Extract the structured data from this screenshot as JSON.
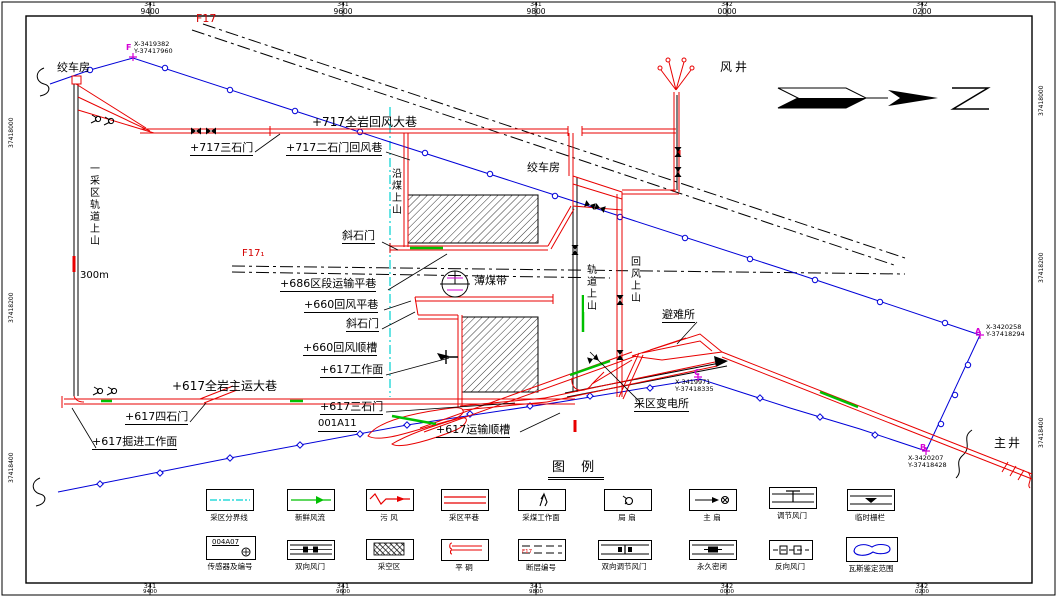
{
  "frame": {
    "top_ticks": [
      {
        "minor": "341",
        "major": "9400"
      },
      {
        "minor": "341",
        "major": "9600"
      },
      {
        "minor": "341",
        "major": "9800"
      },
      {
        "minor": "342",
        "major": "0000"
      },
      {
        "minor": "342",
        "major": "0200"
      }
    ],
    "bottom_ticks": [
      {
        "minor": "341",
        "major": "9400"
      },
      {
        "minor": "341",
        "major": "9600"
      },
      {
        "minor": "341",
        "major": "9800"
      },
      {
        "minor": "342",
        "major": "0000"
      },
      {
        "minor": "342",
        "major": "0200"
      }
    ],
    "left_ticks": [
      "37418000",
      "37418200",
      "37418400"
    ],
    "right_ticks": [
      "37418000",
      "37418200",
      "37418400"
    ]
  },
  "map": {
    "labels": {
      "winch_house_1": "绞车房",
      "winch_house_2": "绞车房",
      "fault_f17": "F17",
      "fault_f17_1": "F17₁",
      "return_717": "+717全岩回风大巷",
      "crosscut3_717": "+717三石门",
      "crosscut2_717": "+717二石门回风巷",
      "yanmei_rise": "沿煤上山",
      "air_shaft": "风井",
      "incline_crosscut_1": "斜石门",
      "incline_crosscut_2": "斜石门",
      "transport_686": "+686区段运输平巷",
      "thin_coal": "薄煤带",
      "return_level_660": "+660回风平巷",
      "return_gate_660": "+660回风顺槽",
      "face_617": "+617工作面",
      "main_haulage_617": "+617全岩主运大巷",
      "crosscut3_617": "+617三石门",
      "code_001a11": "001A11",
      "transport_gate_617": "+617运输顺槽",
      "crosscut4_617": "+617四石门",
      "heading_face_617": "+617掘进工作面",
      "district1_rail_rise": "一采区轨道上山",
      "district1_rail_len": "300m",
      "rail_rise": "轨道上山",
      "return_rise": "回风上山",
      "refuge": "避难所",
      "substation": "采区变电所",
      "main_shaft": "主井"
    },
    "points": {
      "f": {
        "tag": "F",
        "x": "X-3419382",
        "y": "Y-37417960"
      },
      "a": {
        "tag": "A",
        "x": "X-3420258",
        "y": "Y-37418294"
      },
      "b": {
        "tag": "B",
        "x": "X-3420207",
        "y": "Y-37418428"
      },
      "c": {
        "tag": "C",
        "x": "X-3419971",
        "y": "Y-37418335"
      }
    }
  },
  "legend": {
    "title": "图    例",
    "sensor_code": "004A07",
    "fault_code": "F17",
    "items": [
      {
        "label": "采区分界线"
      },
      {
        "label": "新鲜风流"
      },
      {
        "label": "污  风"
      },
      {
        "label": "采区平巷"
      },
      {
        "label": "采煤工作面"
      },
      {
        "label": "局  扇"
      },
      {
        "label": "主  扇"
      },
      {
        "label": "调节风门"
      },
      {
        "label": "临时栅栏"
      },
      {
        "label": "传感器及编号"
      },
      {
        "label": "双向风门"
      },
      {
        "label": "采空区"
      },
      {
        "label": "平  硐"
      },
      {
        "label": "断层编号"
      },
      {
        "label": "双向调节风门"
      },
      {
        "label": "永久密闭"
      },
      {
        "label": "反向风门"
      },
      {
        "label": "瓦斯鉴定范围"
      }
    ]
  },
  "colors": {
    "roadway": "#e80000",
    "survey": "#0000d8",
    "fresh_air": "#00c000",
    "boundary": "#00d2d2",
    "marker": "#d400d4"
  }
}
